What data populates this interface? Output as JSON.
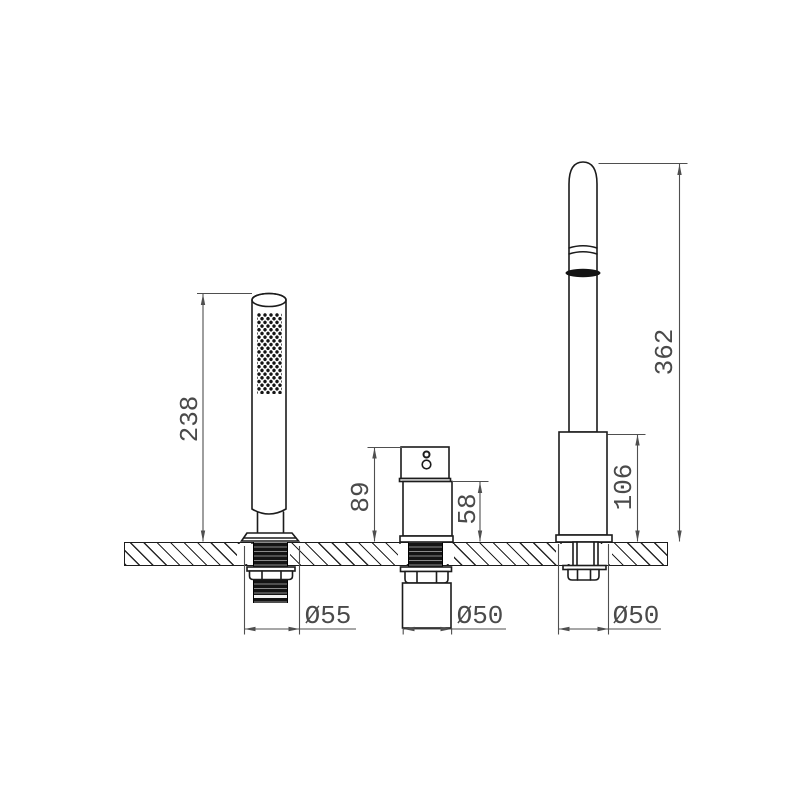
{
  "drawing": {
    "type": "technical-dimension-drawing",
    "subject": "3-hole deck-mounted bath mixer set: hand shower, mixer valve, spout",
    "colors": {
      "background": "#ffffff",
      "outline": "#1c1c1c",
      "dimension": "#4a4a4a",
      "thread_fill": "#141414"
    }
  },
  "labels": {
    "hand_shower_height": "238",
    "hand_shower_base_diameter": "Ø55",
    "valve_height": "89",
    "valve_body_height": "58",
    "valve_base_diameter": "Ø50",
    "spout_height": "362",
    "spout_body_height": "106",
    "spout_base_diameter": "Ø50"
  }
}
